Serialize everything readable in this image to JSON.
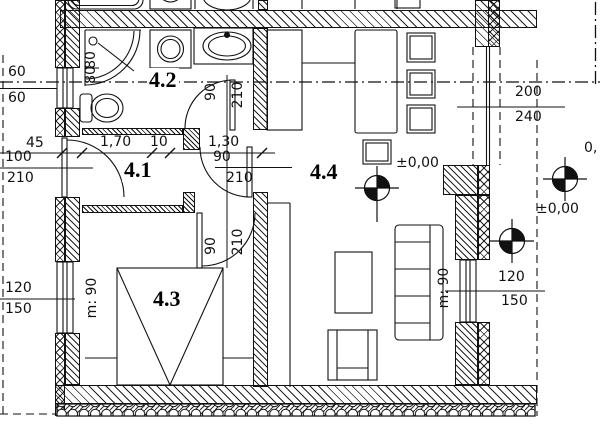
{
  "plan": {
    "title": "apartment-floor-plan",
    "ink": "#111111",
    "paper": "#ffffff",
    "rooms": {
      "corridor": "4.1",
      "bathroom": "4.2",
      "bedroom": "4.3",
      "living": "4.4"
    },
    "dims": {
      "win_left_top_a": "60",
      "win_left_top_b": "60",
      "d45": "45",
      "entry_w": "100",
      "entry_h": "210",
      "win_left_bot_a": "120",
      "win_left_bot_b": "150",
      "d170": "1,70",
      "d10": "10",
      "d130": "1,30",
      "hall_door_w": "90",
      "hall_door_h": "210",
      "bath_door_w": "90",
      "bath_door_h": "210",
      "bed_door_w": "90",
      "bed_door_h": "210",
      "shower_a": "80",
      "shower_b": "80",
      "parapet_left": "m: 90",
      "parapet_right": "m: 90",
      "balcony_w": "200",
      "balcony_h": "240",
      "win_right_a": "120",
      "win_right_b": "150",
      "level_main": "±0,00",
      "level_right": "±0,00",
      "level_edge": "0,"
    }
  }
}
